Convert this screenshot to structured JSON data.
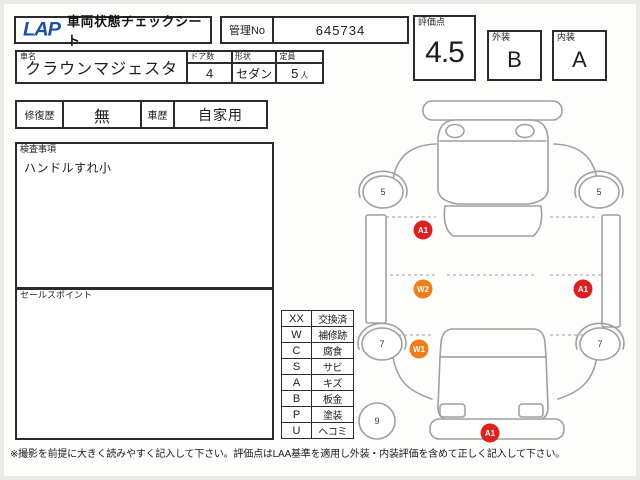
{
  "header": {
    "logo": "LAP",
    "title": "車両状態チェックシート",
    "kanri_label": "管理No",
    "kanri_value": "645734"
  },
  "scores": {
    "hyoka_label": "評価点",
    "hyoka_value": "4.5",
    "gaiso_label": "外装",
    "gaiso_value": "B",
    "naiso_label": "内装",
    "naiso_value": "A"
  },
  "vehicle": {
    "shamei_label": "車名",
    "shamei_value": "クラウンマジェスタ",
    "doors_label": "ドア数",
    "doors_value": "4",
    "shape_label": "形状",
    "shape_value": "セダン",
    "capacity_label": "定員",
    "capacity_value": "5",
    "capacity_unit": "人"
  },
  "history": {
    "shufuku_label": "修復歴",
    "shufuku_value": "無",
    "shareki_label": "車歴",
    "shareki_value": "自家用"
  },
  "inspection": {
    "label": "検査事項",
    "content": "ハンドルすれ小"
  },
  "sales": {
    "label": "セールスポイント",
    "content": ""
  },
  "legend": {
    "rows": [
      {
        "code": "XX",
        "meaning": "交換済"
      },
      {
        "code": "W",
        "meaning": "補修跡"
      },
      {
        "code": "C",
        "meaning": "腐食"
      },
      {
        "code": "S",
        "meaning": "サビ"
      },
      {
        "code": "A",
        "meaning": "キズ"
      },
      {
        "code": "B",
        "meaning": "板金"
      },
      {
        "code": "P",
        "meaning": "塗装"
      },
      {
        "code": "U",
        "meaning": "ヘコミ"
      }
    ]
  },
  "diagram": {
    "tires": [
      {
        "label": "5"
      },
      {
        "label": "5"
      },
      {
        "label": "7"
      },
      {
        "label": "7"
      },
      {
        "label": "9"
      }
    ],
    "damage_marks": [
      {
        "label": "A1",
        "color": "#dc2220"
      },
      {
        "label": "W2",
        "color": "#ee7d1c"
      },
      {
        "label": "A1",
        "color": "#dc2220"
      },
      {
        "label": "W1",
        "color": "#ee7d1c"
      },
      {
        "label": "A1",
        "color": "#dc2220"
      }
    ]
  },
  "footer": {
    "note": "※撮影を前提に大きく読みやすく記入して下さい。評価点はLAA基準を適用し外装・内装評価を含めて正しく記入して下さい。"
  },
  "colors": {
    "accent_red": "#dc2220",
    "accent_orange": "#ee7d1c",
    "logo_blue": "#1d4fa4"
  }
}
